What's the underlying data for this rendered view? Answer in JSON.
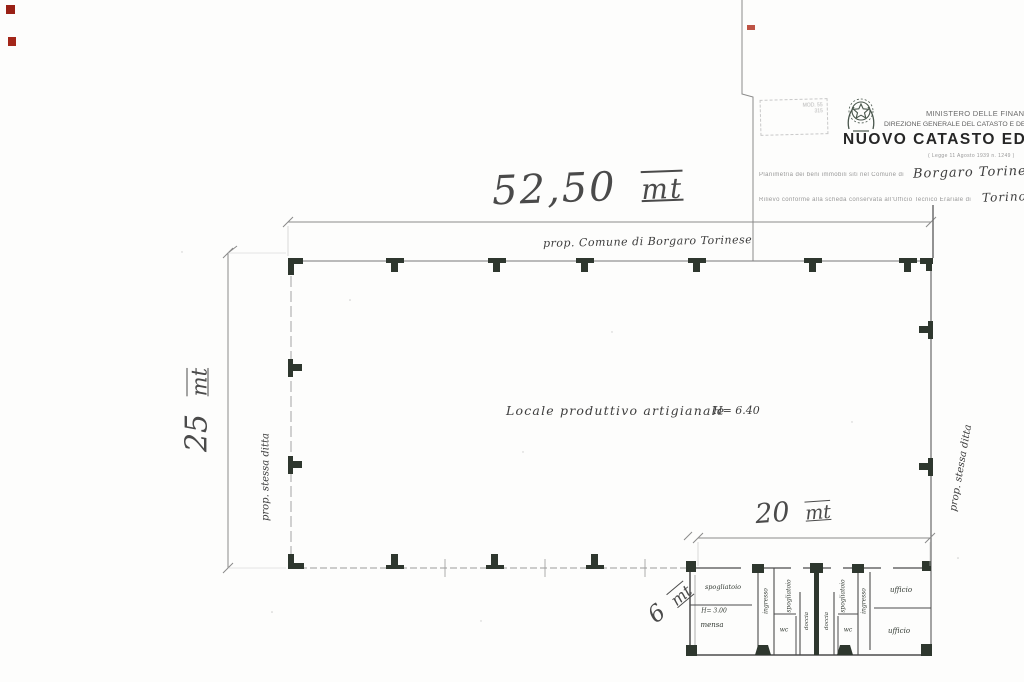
{
  "header": {
    "stamp_line1": "MOD. 55",
    "stamp_line2": "315",
    "ministry_line1": "MINISTERO DELLE FINANZE",
    "ministry_line2": "DIREZIONE GENERALE DEL CATASTO E DEI SERVIZI TECNICI ERARIALI",
    "title": "NUOVO CATASTO EDILIZIO",
    "subtitle_small": "( Legge 11 Agosto 1939  n. 1249 )",
    "form_line1_printed": "Planimetria dei beni immobili siti nel Comune di",
    "form_line1_written": "Borgaro Torinese",
    "form_line2_printed": "Rilievo conforme alla scheda conservata all'Ufficio Tecnico Erariale di",
    "form_line2_written": "Torino"
  },
  "plan": {
    "dims": {
      "width_value": "52,50",
      "width_unit": "mt",
      "height_value": "25",
      "height_unit": "mt",
      "annex_width_value": "20",
      "annex_width_unit": "mt",
      "annex_depth_value": "6",
      "annex_depth_unit": "mt"
    },
    "boundaries": {
      "top": "prop. Comune di Borgaro Torinese",
      "left": "prop. stessa ditta",
      "right": "prop. stessa ditta"
    },
    "main_room": {
      "label": "Locale produttivo artigianale",
      "height": "H= 6.40"
    },
    "annex": {
      "spogliatoio_a": "spogliatoio",
      "mensa_height": "H= 3.00",
      "mensa": "mensa",
      "ingresso_left": "ingresso",
      "spogliatoio_b": "spogliatoio",
      "wc_left": "wc",
      "doccia_left": "doccia",
      "doccia_right": "doccia",
      "spogliatoio_c": "spogliatoio",
      "wc_right": "wc",
      "ingresso_right": "ingresso",
      "ufficio_top": "ufficio",
      "ufficio_bottom": "ufficio"
    }
  },
  "colors": {
    "ink": "#3d3d3d",
    "pillar": "#2e372e",
    "scan_artifact_red": "#9b2015",
    "emblem": "#49564c"
  }
}
